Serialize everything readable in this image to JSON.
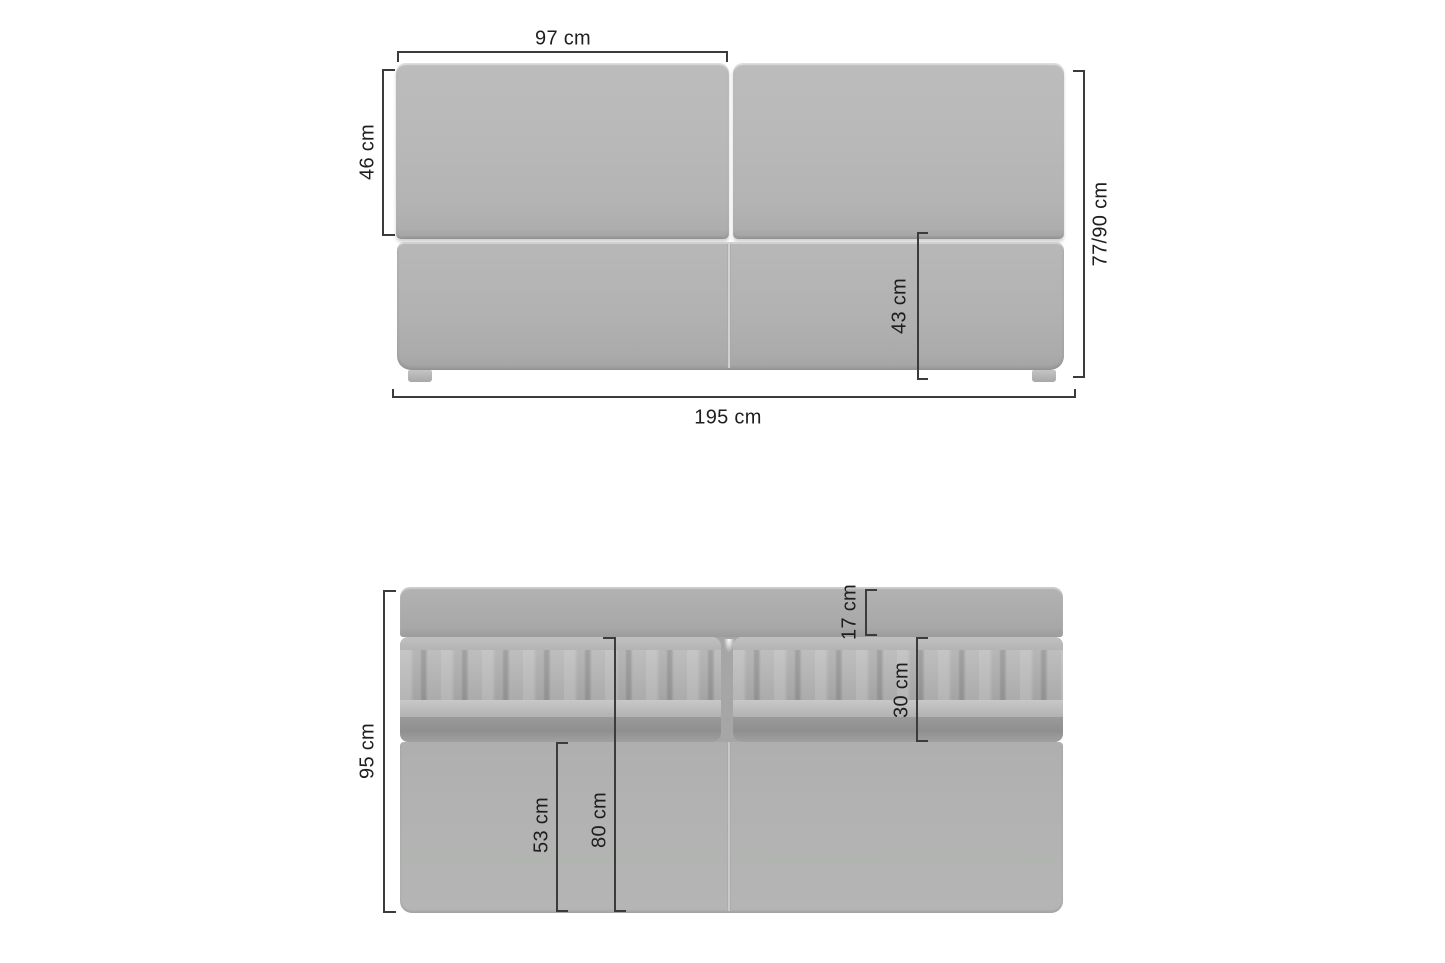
{
  "colors": {
    "background": "#ffffff",
    "dimension_line": "#3b3b3b",
    "label_text": "#1e1e1e",
    "sofa_light": "#bbbcbb",
    "sofa_mid": "#b0b1b0",
    "sofa_shadow": "#8f8f8f"
  },
  "front_view": {
    "dim_backrest_cushion_width": "97 cm",
    "dim_backrest_height": "46 cm",
    "dim_total_height": "77/90 cm",
    "dim_seat_height": "43 cm",
    "dim_total_width": "195 cm"
  },
  "top_view": {
    "dim_total_depth": "95 cm",
    "dim_backrest_depth": "17 cm",
    "dim_cushion_depth": "30 cm",
    "dim_seat_depth": "80 cm",
    "dim_front_depth": "53 cm"
  }
}
